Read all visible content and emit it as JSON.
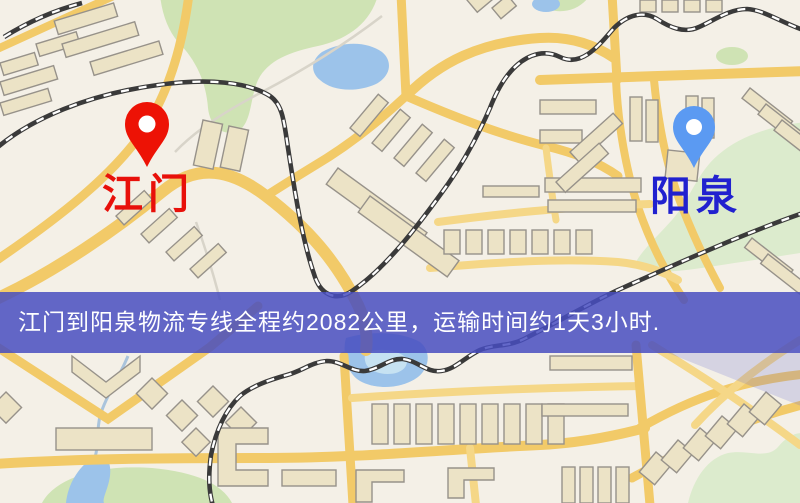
{
  "map": {
    "origin": {
      "label": "江门",
      "pin_color": "#ed1205",
      "label_color": "#e8100a"
    },
    "destination": {
      "label": "阳泉",
      "pin_color": "#5b9af2",
      "label_color": "#2121cf"
    }
  },
  "banner": {
    "text": "江门到阳泉物流专线全程约2082公里，运输时间约1天3小时.",
    "background_color": "#484dc0",
    "text_color": "#ffffff"
  },
  "palette": {
    "map_background": "#f4f0e7",
    "road": "#f2ca68",
    "road_minor": "#f5d787",
    "water": "#9cc3ea",
    "park_green": "#cfe3b4",
    "building_fill": "#ece3c6",
    "building_stroke": "#97928a",
    "railway": "#3a3a3a",
    "overlay_purple": "#686cd2"
  }
}
